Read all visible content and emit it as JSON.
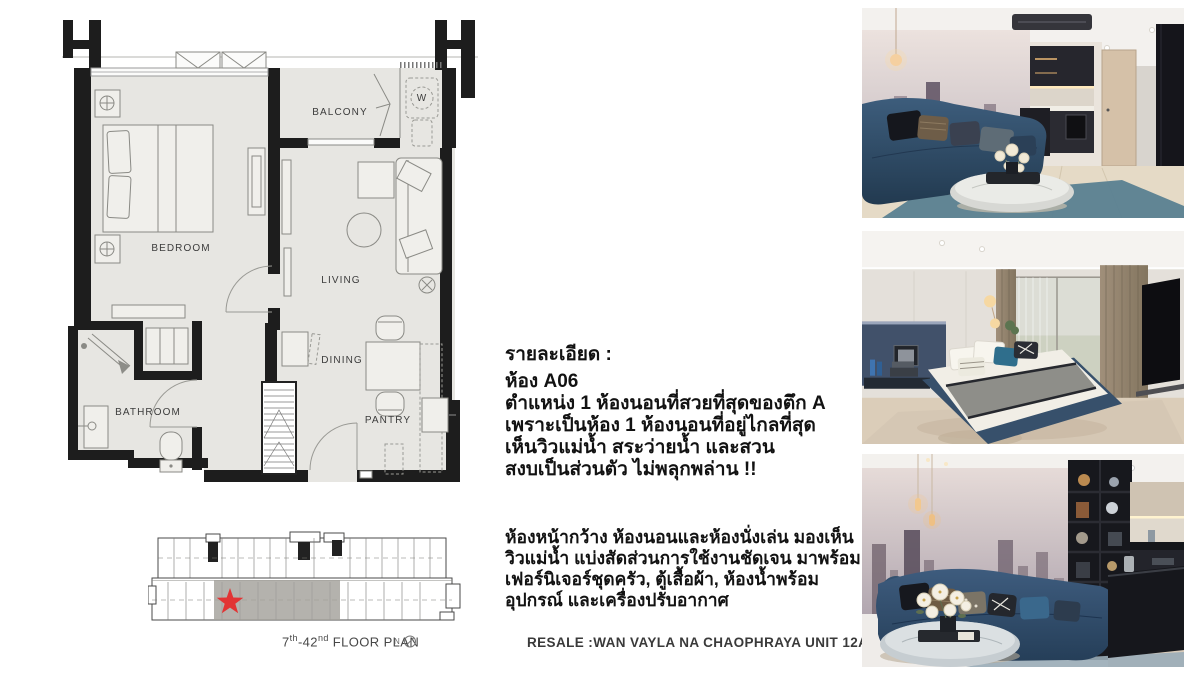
{
  "page": {
    "background": "#ffffff"
  },
  "unit_plan": {
    "labels": {
      "bedroom": "BEDROOM",
      "balcony": "BALCONY",
      "living": "LIVING",
      "dining": "DINING",
      "pantry": "PANTRY",
      "bathroom": "BATHROOM",
      "washer": "W"
    }
  },
  "building_plan": {
    "caption": {
      "floor_from": "7",
      "floor_from_sup": "th",
      "floor_to": "-42",
      "floor_to_sup": "nd",
      "label": " FLOOR PLAN"
    },
    "north_label": "N",
    "marker_color": "#e23434",
    "highlight_color": "#a4a19b"
  },
  "details": {
    "heading": "รายละเอียด :",
    "unit_title": "ห้อง A06",
    "para1": [
      "ตำแหน่ง 1 ห้องนอนที่สวยที่สุดของตึก A",
      "เพราะเป็นห้อง 1 ห้องนอนที่อยู่ไกลที่สุด",
      "เห็นวิวแม่น้ำ สระว่ายน้ำ และสวน",
      "สงบเป็นส่วนตัว ไม่พลุกพล่าน !!"
    ],
    "para2": [
      "ห้องหน้ากว้าง ห้องนอนและห้องนั่งเล่น มองเห็น",
      "วิวแม่น้ำ แบ่งสัดส่วนการใช้งานชัดเจน มาพร้อม",
      "เฟอร์นิเจอร์ชุดครัว, ตู้เสื้อผ้า, ห้องน้ำพร้อม",
      "อุปกรณ์ และเครื่องปรับอากาศ"
    ],
    "footer": "RESALE :WAN VAYLA NA CHAOPHRAYA UNIT 12A06"
  },
  "photos": [
    {
      "id": "living-room-with-kitchen"
    },
    {
      "id": "bedroom"
    },
    {
      "id": "living-room-sofa-detail"
    }
  ]
}
